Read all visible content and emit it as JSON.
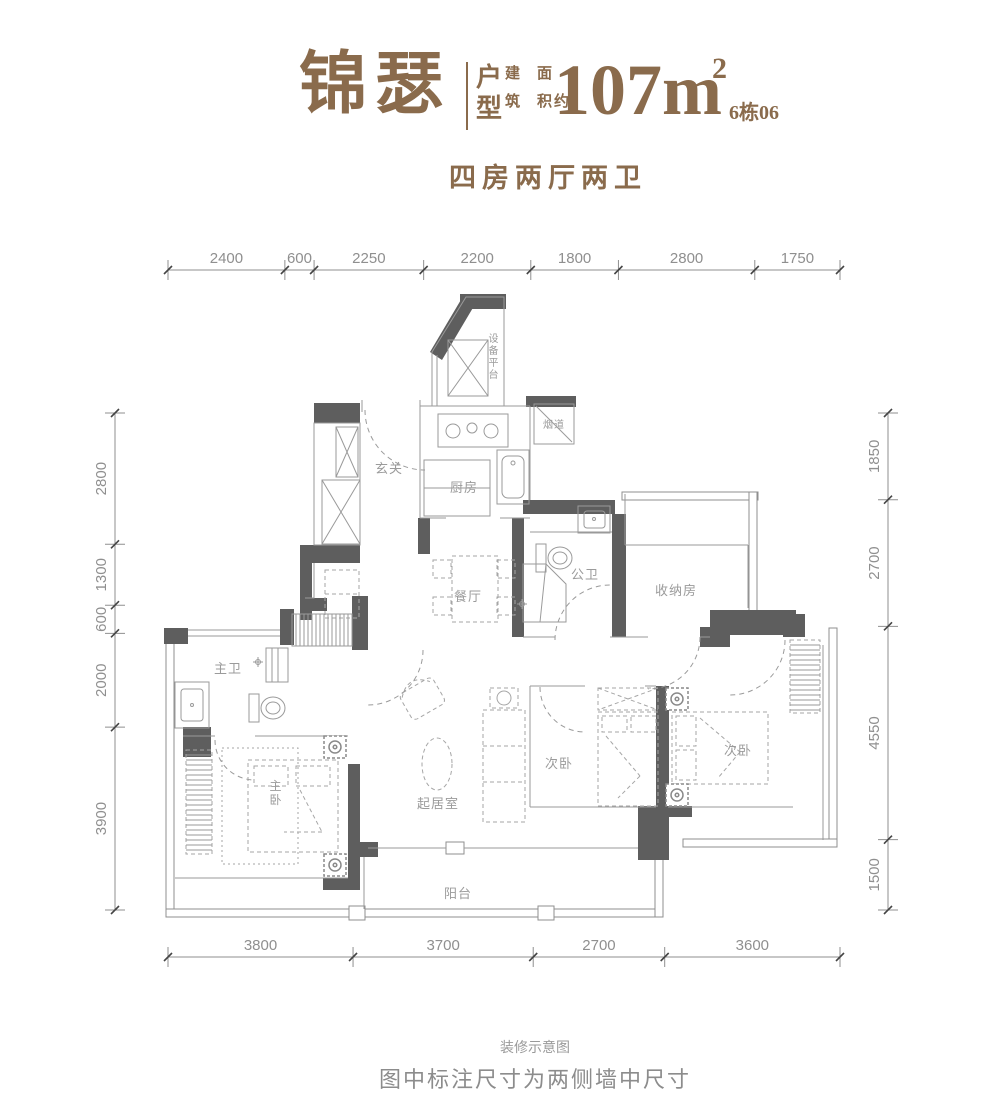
{
  "header": {
    "brand": "锦瑟",
    "type_label": "户型",
    "area_label": "建筑面积约",
    "area_value": "107m",
    "area_exponent": "2",
    "unit_code": "6栋06",
    "subtitle": "四房两厅两卫"
  },
  "colors": {
    "brand_brown": "#8a6b4c",
    "wall_gray": "#5e5e5e",
    "line_gray": "#9a9a9a",
    "dim_text_gray": "#8f8f8f"
  },
  "dimensions": {
    "top": [
      "2400",
      "600",
      "2250",
      "2200",
      "1800",
      "2800",
      "1750"
    ],
    "bottom": [
      "3800",
      "3700",
      "2700",
      "3600"
    ],
    "left": [
      "2800",
      "1300",
      "600",
      "2000",
      "3900"
    ],
    "right": [
      "1850",
      "2700",
      "4550",
      "1500"
    ]
  },
  "rooms": [
    {
      "name": "设备平台",
      "x": 494,
      "y": 342,
      "vertical": true,
      "size": 10
    },
    {
      "name": "烟道",
      "x": 554,
      "y": 428,
      "size": 10
    },
    {
      "name": "玄关",
      "x": 389,
      "y": 473,
      "size": 13
    },
    {
      "name": "厨房",
      "x": 464,
      "y": 492,
      "size": 13
    },
    {
      "name": "餐厅",
      "x": 468,
      "y": 601,
      "size": 13
    },
    {
      "name": "公卫",
      "x": 585,
      "y": 579,
      "size": 13
    },
    {
      "name": "收纳房",
      "x": 676,
      "y": 595,
      "size": 13
    },
    {
      "name": "主卫",
      "x": 228,
      "y": 673,
      "size": 13
    },
    {
      "name": "主卧",
      "x": 276,
      "y": 790,
      "vertical": true,
      "size": 12
    },
    {
      "name": "起居室",
      "x": 438,
      "y": 808,
      "size": 13
    },
    {
      "name": "次卧",
      "x": 559,
      "y": 768,
      "size": 13
    },
    {
      "name": "次卧",
      "x": 738,
      "y": 755,
      "size": 13
    },
    {
      "name": "阳台",
      "x": 458,
      "y": 898,
      "size": 13
    }
  ],
  "footer": {
    "note": "装修示意图",
    "caption": "图中标注尺寸为两侧墙中尺寸"
  }
}
